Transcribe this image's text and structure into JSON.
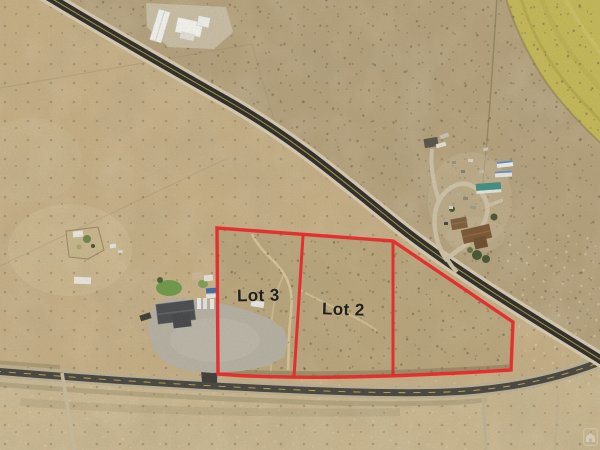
{
  "overlay": {
    "boundary_color": "#e8262b",
    "lots": [
      {
        "name": "lot-3",
        "label": "Lot 3"
      },
      {
        "name": "lot-2",
        "label": "Lot 2"
      }
    ]
  },
  "colors": {
    "terrain_tan": "#c7b086",
    "crop_field_yellow": "#c6ba58",
    "highway_asphalt": "#2b2a28",
    "frontage_road_asphalt": "#45443f",
    "label_text": "#202020"
  },
  "icons": {
    "watermark": "house-watermark-icon"
  }
}
